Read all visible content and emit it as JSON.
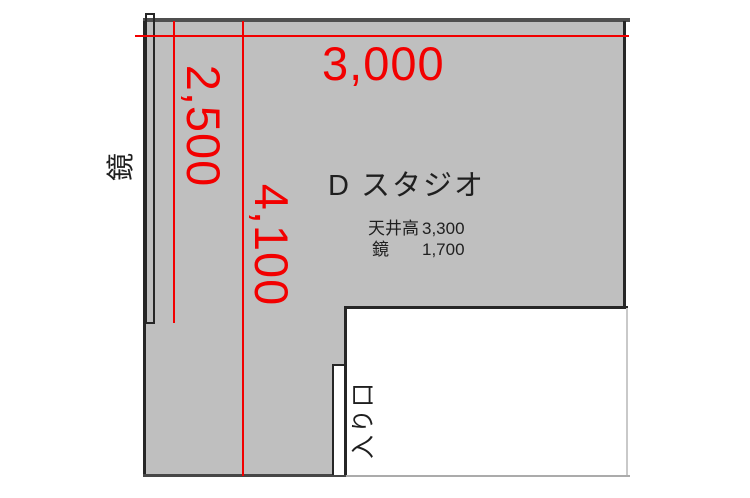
{
  "palette": {
    "room_fill": "#bfbfbf",
    "wall": "#262626",
    "top_wall": "#4f4f4f",
    "bottom_dark": "#474747",
    "bottom_light": "#ababab",
    "notch_light": "#c9c9c9",
    "dimension": "#f20000",
    "text": "#1f1f1f"
  },
  "room": {
    "title": "D スタジオ"
  },
  "dimensions": {
    "top_width": "3,000",
    "left_height_upper": "2,500",
    "left_height_lower": "4,100"
  },
  "specs": [
    {
      "label": "天井高",
      "value": "3,300"
    },
    {
      "label": "鏡",
      "value": "1,700"
    }
  ],
  "labels": {
    "mirror": "鏡",
    "entrance": "入り口"
  }
}
